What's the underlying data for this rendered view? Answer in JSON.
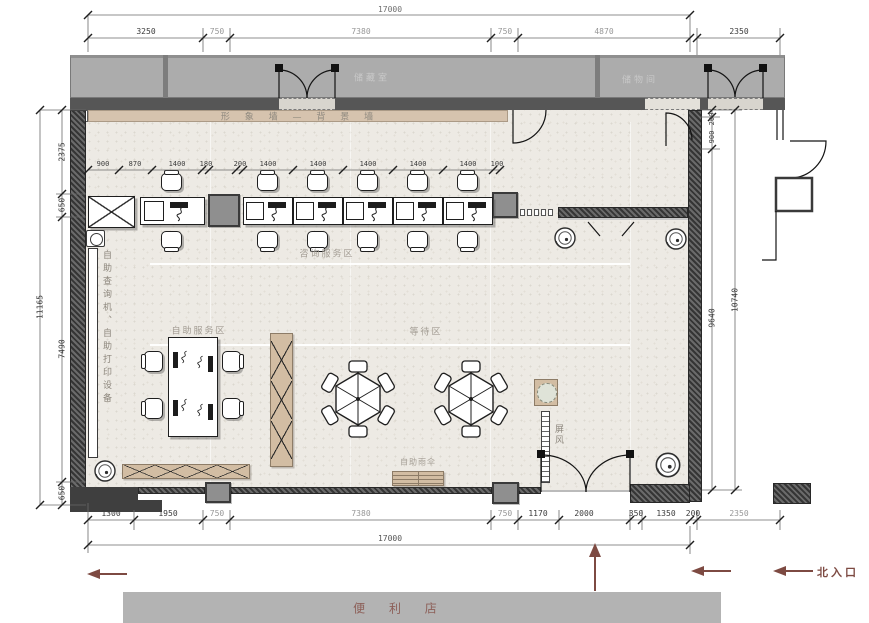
{
  "colors": {
    "accent_red": "#7d4a42",
    "wall_dark": "#3e3e3e",
    "storage_band_gray": "#acacac",
    "feature_wall_beige": "#d6c3ae",
    "floor": "#edeae4"
  },
  "labels": {
    "storage_left": "储藏室",
    "storage_right": "储物间",
    "feature_wall": "形 象 墙 — 背 景 墙",
    "consult_zone": "咨询服务区",
    "self_service_zone": "自助服务区",
    "waiting_zone": "等待区",
    "screen": "屏风",
    "umbrella_stand": "自助雨伞",
    "side_equipment": "自助查询机、自助打印设备",
    "north_entrance": "北入口",
    "convenience_store": "便 利 店"
  },
  "dims": {
    "top_total": "17000",
    "top_segments": [
      "3250",
      "750",
      "7380",
      "750",
      "4870"
    ],
    "top_right": "2350",
    "desk_row": [
      "900",
      "870",
      "1400",
      "180",
      "200",
      "1400",
      "1400",
      "1400",
      "1400",
      "1400",
      "100"
    ],
    "left_total": "11165",
    "left_segments": [
      "2375",
      "650",
      "7490",
      "650"
    ],
    "right_total": "10740",
    "right_segments": [
      "200",
      "900",
      "9640"
    ],
    "bottom_segments": [
      "1300",
      "1950",
      "750",
      "7380",
      "750",
      "1170",
      "2000",
      "350",
      "1350",
      "200",
      "2350"
    ],
    "bottom_total": "17000"
  }
}
